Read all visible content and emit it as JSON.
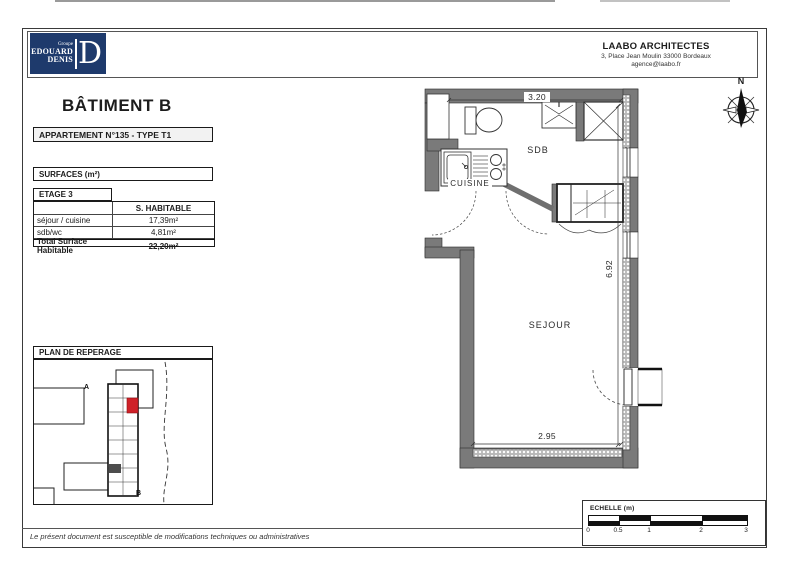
{
  "header": {
    "logo": {
      "group": "Groupe",
      "name1": "EDOUARD",
      "name2": "DENIS",
      "monogram": "D"
    },
    "architect": {
      "name": "LAABO ARCHITECTES",
      "address": "3, Place Jean Moulin  33000 Bordeaux",
      "email": "agence@laabo.fr"
    }
  },
  "title": "BÂTIMENT B",
  "apartment_box": "APPARTEMENT N°135 - TYPE T1",
  "surfaces_box": "SURFACES (m²)",
  "table": {
    "floor_label": "ETAGE 3",
    "col_header": "S. HABITABLE",
    "rows": [
      {
        "label": "séjour / cuisine",
        "value": "17,39m²"
      },
      {
        "label": "sdb/wc",
        "value": "4,81m²"
      }
    ],
    "total_label": "Total Surface Habitable",
    "total_value": "22,20m²"
  },
  "reperage": {
    "title": "PLAN DE REPERAGE",
    "building_a": "A",
    "building_b": "B"
  },
  "plan": {
    "rooms": {
      "sdb": "SDB",
      "cuisine": "CUISINE",
      "sejour": "SEJOUR"
    },
    "dimensions": {
      "top": "3.20",
      "right": "6.92",
      "bottom": "2.95"
    }
  },
  "compass": {
    "north": "N"
  },
  "scale_bar": {
    "label": "ECHELLE (m)",
    "ticks": [
      "0",
      "0.5",
      "1",
      "2",
      "3"
    ]
  },
  "footer": "Le présent document est susceptible de modifications techniques ou administratives",
  "colors": {
    "accent_red": "#cf2128",
    "logo_navy": "#1e3a6c",
    "wall_gray": "#7a7a7a"
  }
}
